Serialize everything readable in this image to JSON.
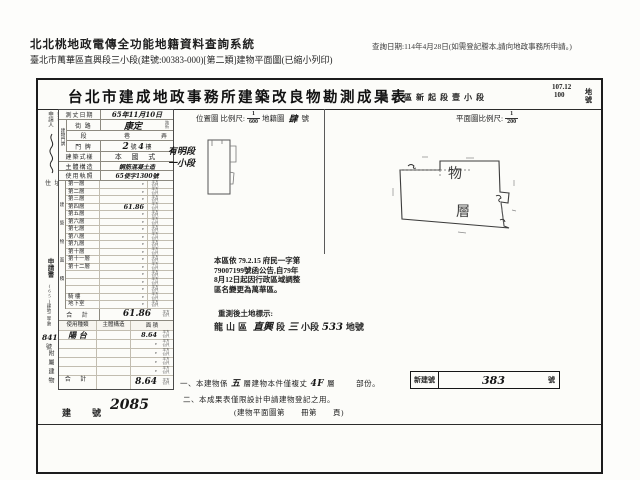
{
  "header": {
    "system_title": "北北桃地政電傳全功能地籍資料查詢系統",
    "page_subtitle": "臺北市萬華區直興段三小段(建號:00383-000)[第二類]建物平面圖(已縮小列印)",
    "query_date": "查詢日期:114年4月28日(如需登記謄本,請向地政事務所申請。)"
  },
  "form": {
    "title": "台北市建成地政事務所建築改良物勘測成果表",
    "district_line": "龍山區新起段壹小段",
    "parcel_top": "107.12",
    "parcel_bottom": "100",
    "parcel_unit": "地號",
    "location_map": {
      "label": "位置圖 比例尺:",
      "num": "1",
      "den": "600",
      "cadastral_label": "地籍圖",
      "cadastral_value": "肆",
      "cadastral_unit": "號"
    },
    "plan_scale": {
      "label": "平面圖比例尺:",
      "num": "1",
      "den": "200"
    },
    "applicant": {
      "label_1": "申請人",
      "label_2": "姓名",
      "address_label": "住 址"
    },
    "fields": {
      "survey_date_label": "測丈日期",
      "survey_date": "65年11月10日",
      "door_group_label": "建物門牌",
      "street_label": "街 路",
      "street_value": "康定",
      "street_opt_1": "路",
      "street_opt_2": "街",
      "lane_label_1": "段",
      "lane_label_2": "巷",
      "lane_label_3": "弄",
      "door_label": "門 牌",
      "door_no": "2",
      "door_no_unit": "號",
      "door_floor": "4",
      "door_floor_unit": "樓",
      "style_label": "建築式樣",
      "style_value": "本 國 式",
      "structure_label": "主體構造",
      "structure_value": "鋼筋混凝土造",
      "license_label": "使用執照",
      "license_value": "65使字1300號"
    },
    "area_table": {
      "group_label": "建築物面積",
      "unit_1": "平方",
      "unit_2": "公尺",
      "floors": [
        {
          "label": "第一層",
          "value": "·"
        },
        {
          "label": "第二層",
          "value": "·"
        },
        {
          "label": "第三層",
          "value": "·"
        },
        {
          "label": "第四層",
          "value": "61.86"
        },
        {
          "label": "第五層",
          "value": "·"
        },
        {
          "label": "第六層",
          "value": "·"
        },
        {
          "label": "第七層",
          "value": "·"
        },
        {
          "label": "第八層",
          "value": "·"
        },
        {
          "label": "第九層",
          "value": "·"
        },
        {
          "label": "第十層",
          "value": "·"
        },
        {
          "label": "第十一層",
          "value": "·"
        },
        {
          "label": "第十二層",
          "value": "·"
        },
        {
          "label": "",
          "value": "·"
        },
        {
          "label": "",
          "value": "·"
        },
        {
          "label": "",
          "value": "·"
        },
        {
          "label": "騎 樓",
          "value": "·"
        },
        {
          "label": "地下室",
          "value": "·"
        }
      ],
      "total_label": "合 計",
      "total_value": "61.86"
    },
    "annex_table": {
      "group_label": "附屬建物",
      "headers": {
        "use": "使用種類",
        "structure": "主體構造",
        "area": "面 積"
      },
      "rows": [
        {
          "use": "陽 台",
          "structure": "",
          "area": "8.64"
        },
        {
          "use": "",
          "structure": "",
          "area": "·"
        },
        {
          "use": "",
          "structure": "",
          "area": "·"
        },
        {
          "use": "",
          "structure": "",
          "area": "·"
        },
        {
          "use": "",
          "structure": "",
          "area": "·"
        }
      ],
      "total_label": "合 計",
      "total_value": "8.64"
    },
    "margin_note": {
      "line_1": "申請書",
      "line_2": "(65)建地二字第",
      "number": "8410",
      "unit": "號"
    },
    "sketch": {
      "section_line_1": "有明段",
      "section_line_2": "一小段"
    },
    "plan": {
      "char_1": "物",
      "char_2": "層"
    },
    "stamp": {
      "line_1": "本區依 79.2.15 府民一字第",
      "line_2": "79007199號函公告,自79年",
      "line_3": "8月12日起因行政區域調整",
      "line_4": "區名變更為萬華區。"
    },
    "resurvey": {
      "label": "重測後土地標示:",
      "prefix": "龍山區",
      "hand_1": "直興",
      "mid_1": "段",
      "hand_2": "三",
      "mid_2": "小段",
      "hand_3": "533",
      "suffix": "地號"
    },
    "notes": {
      "n1_prefix": "一、本建物係",
      "n1_hand_1": "五",
      "n1_mid": "層建物本件僅複丈",
      "n1_hand_2": "4F",
      "n1_suffix": "層",
      "n1_suffix_2": "部份。",
      "new_no_label": "新建號",
      "new_no_value": "383",
      "new_no_unit": "號",
      "n2": "二、本成果表僅限設計申請建物登記之用。"
    },
    "footer": {
      "building_no_label": "建　號",
      "building_no_value": "2085",
      "plan_ref": "(建物平面圖第　　冊第　　頁)"
    }
  }
}
